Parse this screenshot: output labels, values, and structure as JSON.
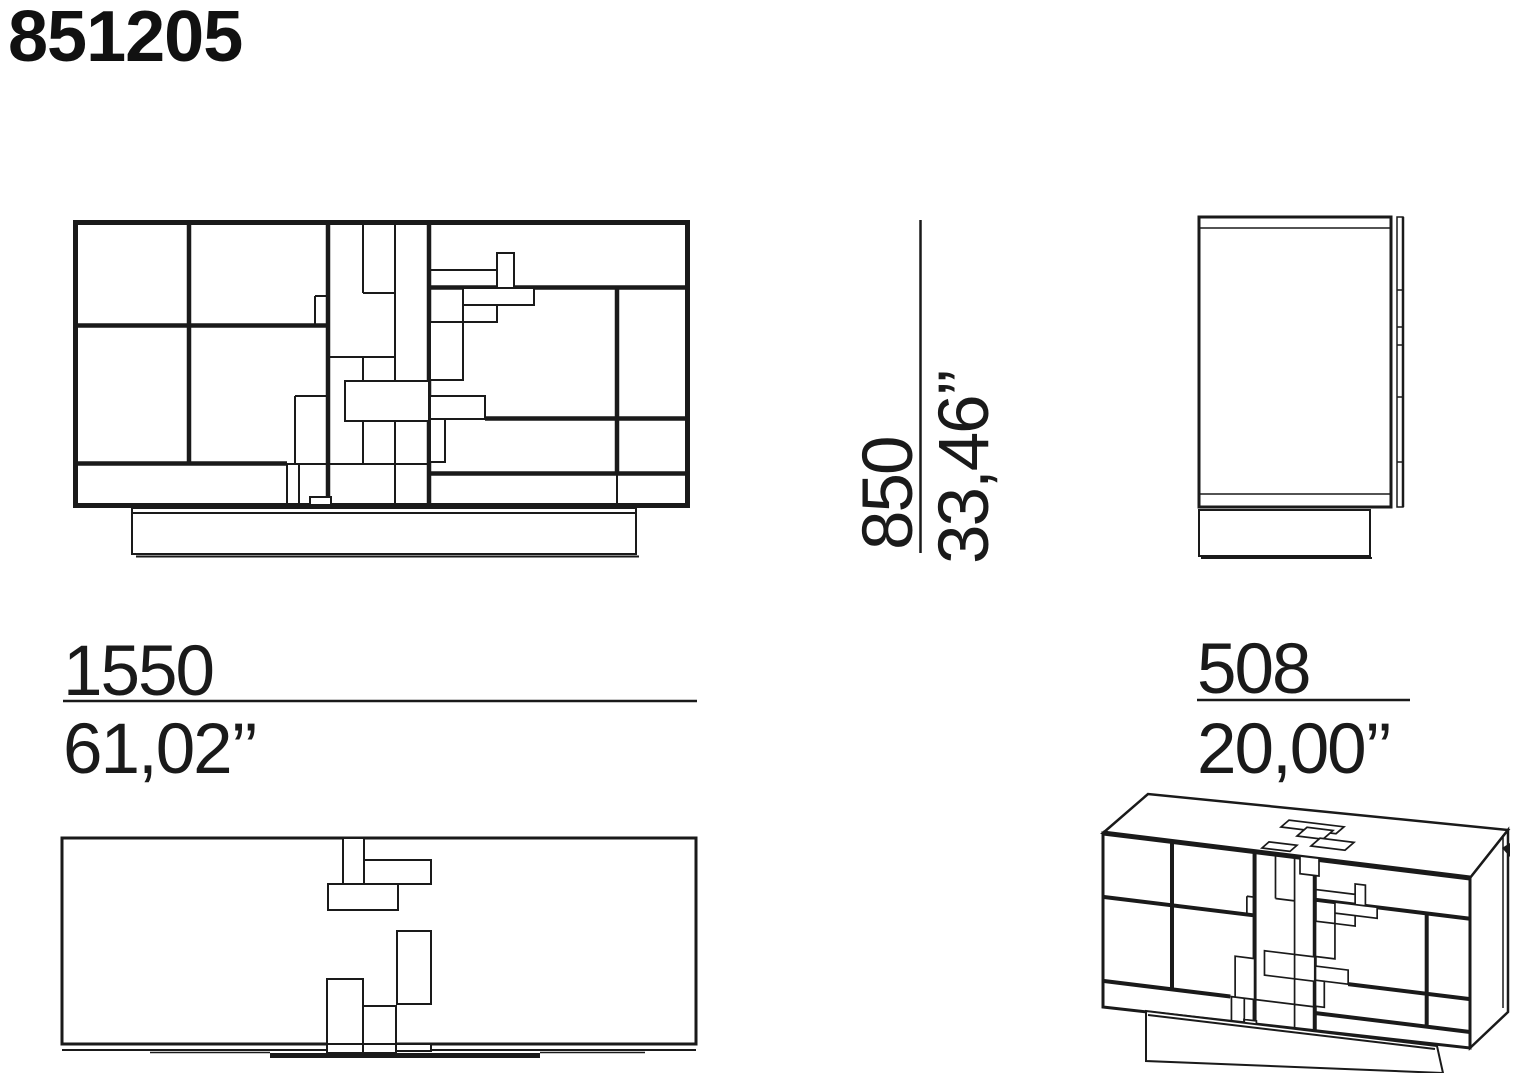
{
  "header": {
    "product_code": "851205"
  },
  "dimensions": {
    "height": {
      "mm": "850",
      "inches": "33,46’’"
    },
    "width": {
      "mm": "1550",
      "inches": "61,02’’"
    },
    "depth": {
      "mm": "508",
      "inches": "20,00’’"
    }
  },
  "style": {
    "background": "#ffffff",
    "line_color": "#1a1a1a",
    "text_color": "#1a1a1a"
  }
}
